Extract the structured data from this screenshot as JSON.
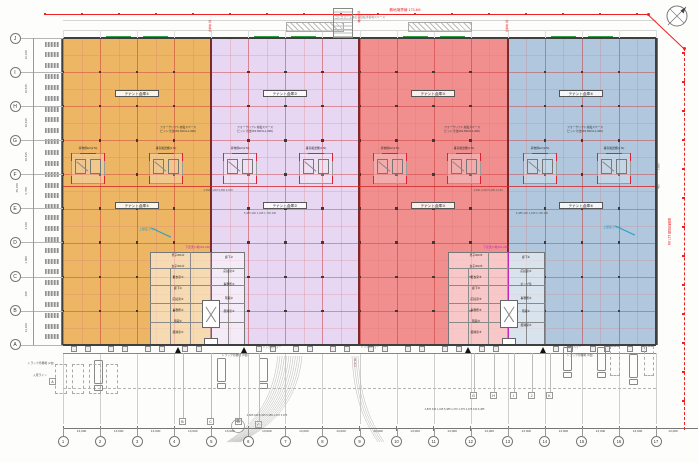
{
  "boundaries": {
    "top_label": "敷地境界線 173.4M",
    "right_label": "敷地境界線 117.9M"
  },
  "zones": [
    {
      "label": "テナント倉庫①",
      "color": "#eab057"
    },
    {
      "label": "テナント倉庫②",
      "color": "#e6d4f2"
    },
    {
      "label": "テナント倉庫③",
      "color": "#f08585"
    },
    {
      "label": "テナント倉庫④",
      "color": "#a9c2da"
    }
  ],
  "notes": {
    "forklift1": "フォークリフト充電スペース",
    "forklift2": "ピット寸法(W1,500×L1,000)",
    "bicycle": "コンクリート縁石・自転車置場スペース",
    "fire_tank": "防火水槽",
    "fire_zone": "防火区画",
    "dock_leveler": "ドックレベラー",
    "truck_wait_2": "トラック待機場 (2台)",
    "truck_wait_9": "トラック待機場 (9台)",
    "entry_line": "入庫ライン",
    "gate": "出入口",
    "canopy": "上部庇ライン",
    "ev": "荷物用EV(2.5t)",
    "lifter": "垂直搬送機(1.5t)"
  },
  "grid": {
    "bottom_numbers": [
      "1",
      "2",
      "3",
      "4",
      "5",
      "6",
      "7",
      "8",
      "9",
      "10",
      "11",
      "12",
      "13",
      "14",
      "15",
      "16",
      "17"
    ],
    "bottom_dims": [
      "13,000",
      "13,000",
      "13,000",
      "13,000",
      "13,000",
      "13,000",
      "13,000",
      "13,000",
      "13,000",
      "13,000",
      "13,000",
      "13,000",
      "13,000",
      "13,000",
      "13,000",
      "13,000"
    ],
    "extra_dim": "13,000",
    "left_letters": [
      "J",
      "I",
      "H",
      "G",
      "F",
      "E",
      "D",
      "C",
      "B",
      "A"
    ],
    "left_dims": [
      "12,100",
      "10,815",
      "10,815",
      "10,815",
      "6,700",
      "4,100",
      "1,800",
      "495",
      "13,100"
    ],
    "left_total": "65,150",
    "right_dims": [
      "1,800",
      "495"
    ]
  },
  "stalls": {
    "wait": "A",
    "left": [
      "B",
      "C",
      "D",
      "F"
    ],
    "right": [
      "G",
      "H",
      "I",
      "J",
      "K"
    ]
  },
  "cores": [
    {
      "note": "下足洗い場(W1,200)",
      "left": [
        "男子WC①",
        "女子WC①",
        "更衣室①",
        "廊下①",
        "応接室①",
        "事務所①",
        "階段①",
        "風除室①"
      ],
      "right": [
        "廊下②",
        "応接室②",
        "事務所②",
        "階段②",
        "風除室②"
      ]
    },
    {
      "note": "下足洗い場(W1,200)",
      "left": [
        "男子WC③",
        "女子WC③",
        "更衣室③",
        "廊下③",
        "応接室③",
        "事務所③",
        "階段③",
        "風除室③"
      ],
      "right": [
        "廊下④",
        "応接室④",
        "ポンプ室",
        "事務所④",
        "階段④",
        "風除室④"
      ]
    }
  ],
  "dims": {
    "mid_a": "4,350  3,200  5,450  4,150",
    "mid_b": "5,485 430 1,345 1,730 430",
    "bottom_a": "4,825 340 5,345 5,385 1,370 3,375",
    "bottom_b": "4,825 345 1,345 5,385 1,370 1,375 4,375 430 5,485"
  }
}
